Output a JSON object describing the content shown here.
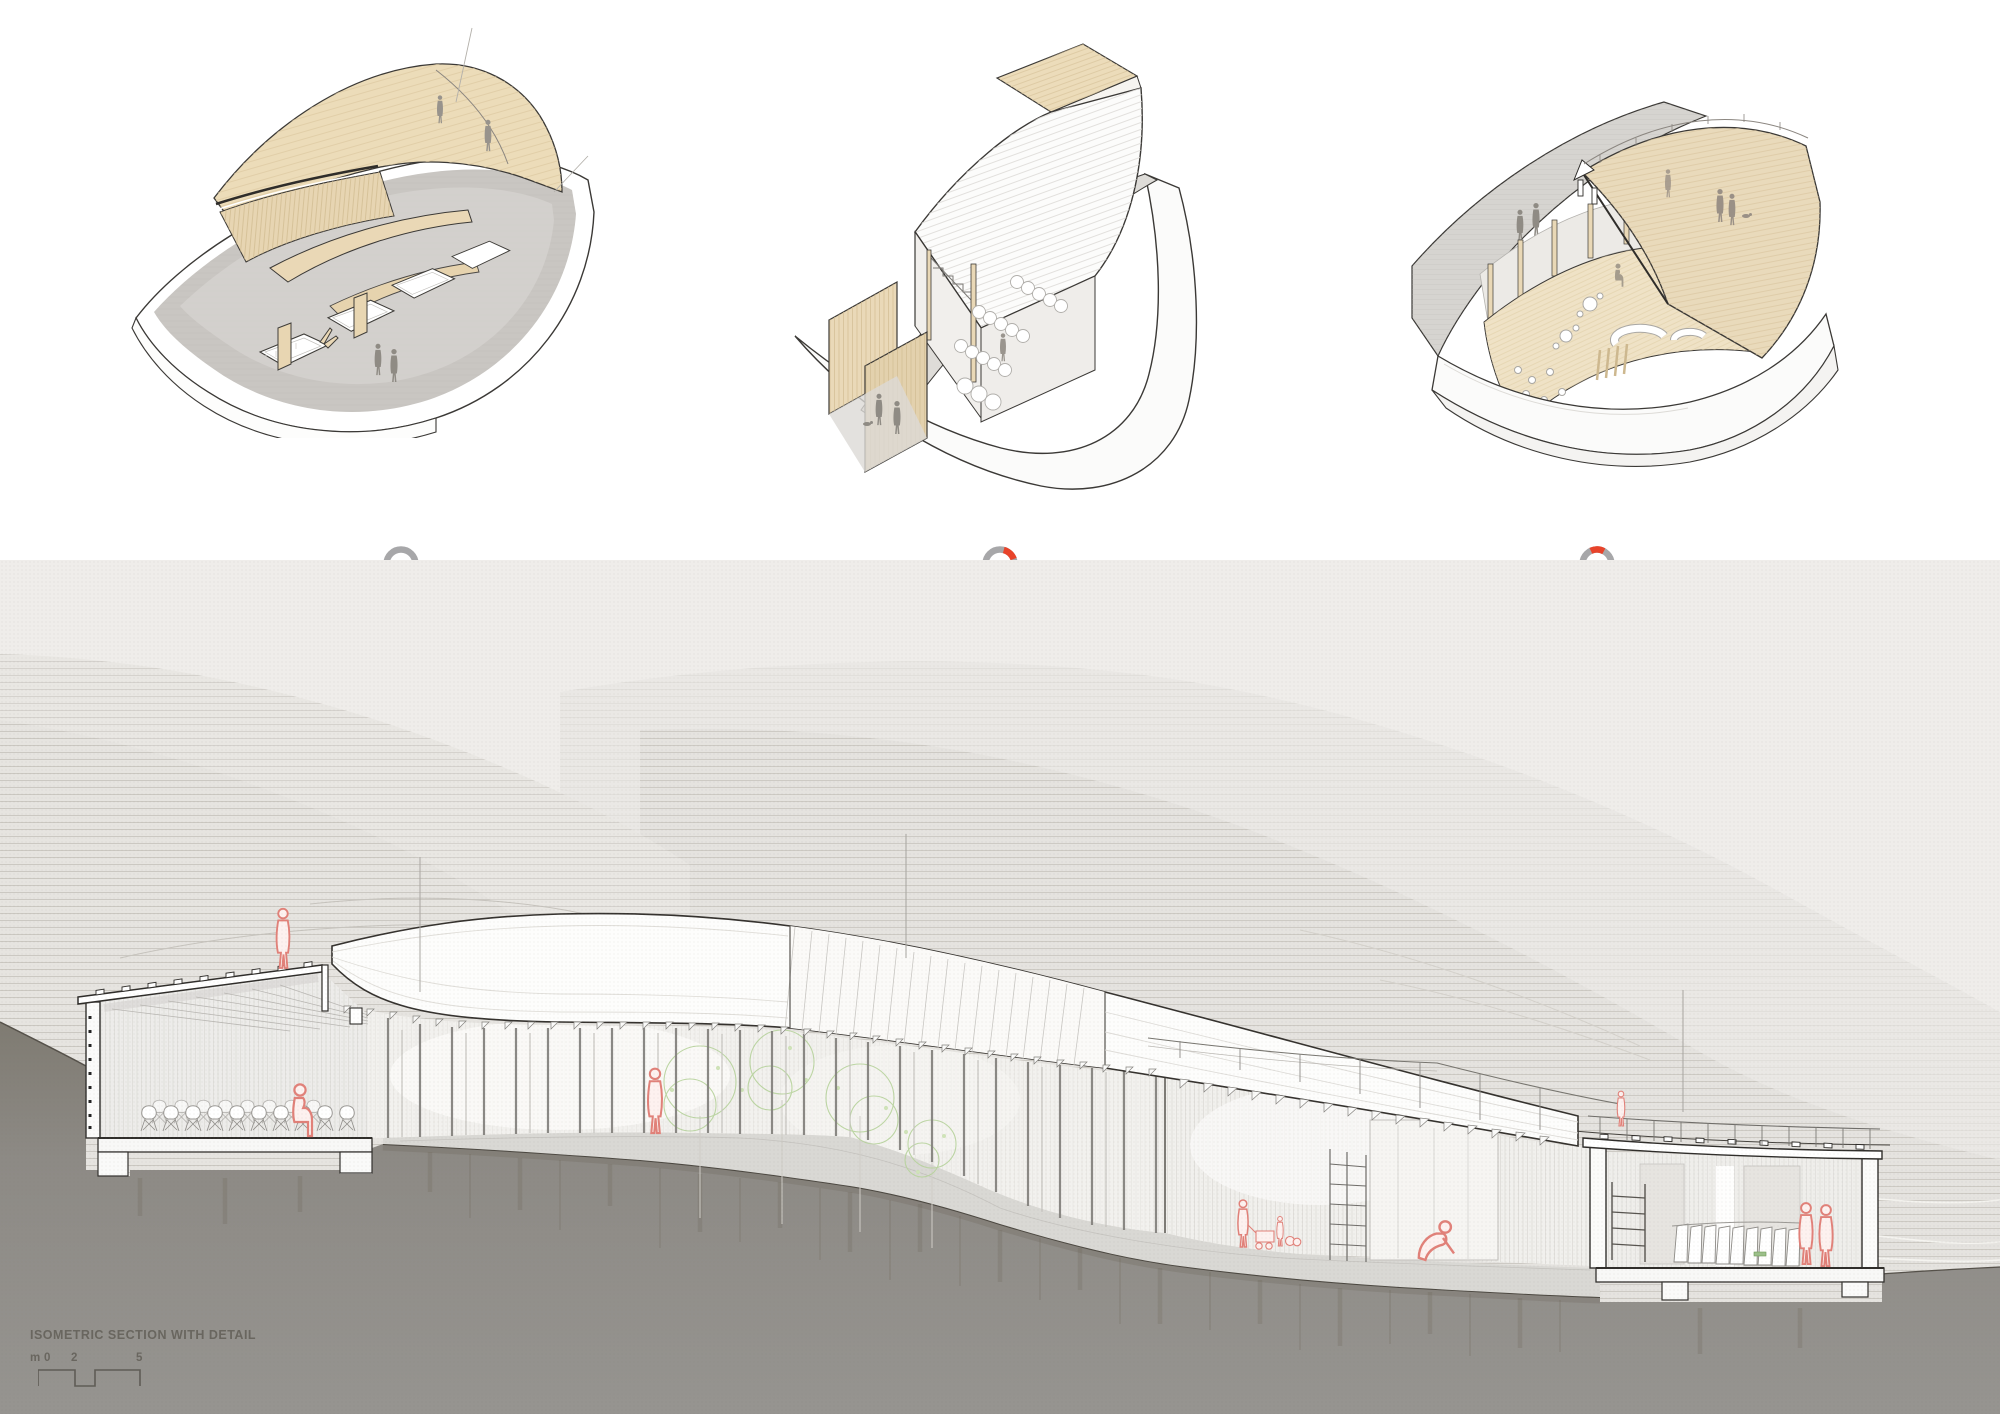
{
  "panels": [
    {
      "id": "resource",
      "icon": "ring-marker-bottom-segment",
      "title": "RESOURCE COLLECTION ZONE",
      "body": "The recycling centre is located on the lower part of the terrain, where people can park in the off-street outdoor car park and conveniently dispose of larger or heavier items of different waste in the different recycling bins. Behind the bins, on the other hand, is the second-hand resource exchange point, where people can leave unwanted items on the shelves or pick up needed items. Both of these functions are also connected to the waste disposal centre at the back."
    },
    {
      "id": "greenhouse",
      "icon": "ring-marker-top-right-segment",
      "title": "GREENHOUSE & ORGANIC WASTE COLLECTION",
      "body": "The greenhouse is divided vertically into three steps in order to connect the different elevations of the high and low points of the site in terms of flow. Functionally it links the waste collection system, the sec- ond-hand exchange point and the activity centre."
    },
    {
      "id": "community",
      "icon": "ring-marker-top-segment",
      "title": "MULTIPURPOSE COMMUNITY ROOM  & ROOM FOR TOURISTS",
      "body": "The visitor centre and function room are divided by folding doors into two spaces, which can be flexibly split or combined into two or one space for events of different sizes. The two function spaces are located at the highest point of the terrain, thus providing the best view of the lake."
    }
  ],
  "section_footer": {
    "label": "ISOMETRIC SECTION WITH DETAIL",
    "scale_unit": "m",
    "scale_ticks": [
      "0",
      "2",
      "5"
    ]
  },
  "colors": {
    "accent_red": "#e8432a",
    "ring_gray": "#a7a7a9",
    "wood_beige": "#ecdcba",
    "concrete": "#c9c6c2",
    "earth": "#8d8a85",
    "paper": "#efedea",
    "figure_red": "#e18179",
    "tree_green": "#b7d39c",
    "text_dark": "#1d1d1b",
    "text_gray": "#6e6d6b"
  }
}
